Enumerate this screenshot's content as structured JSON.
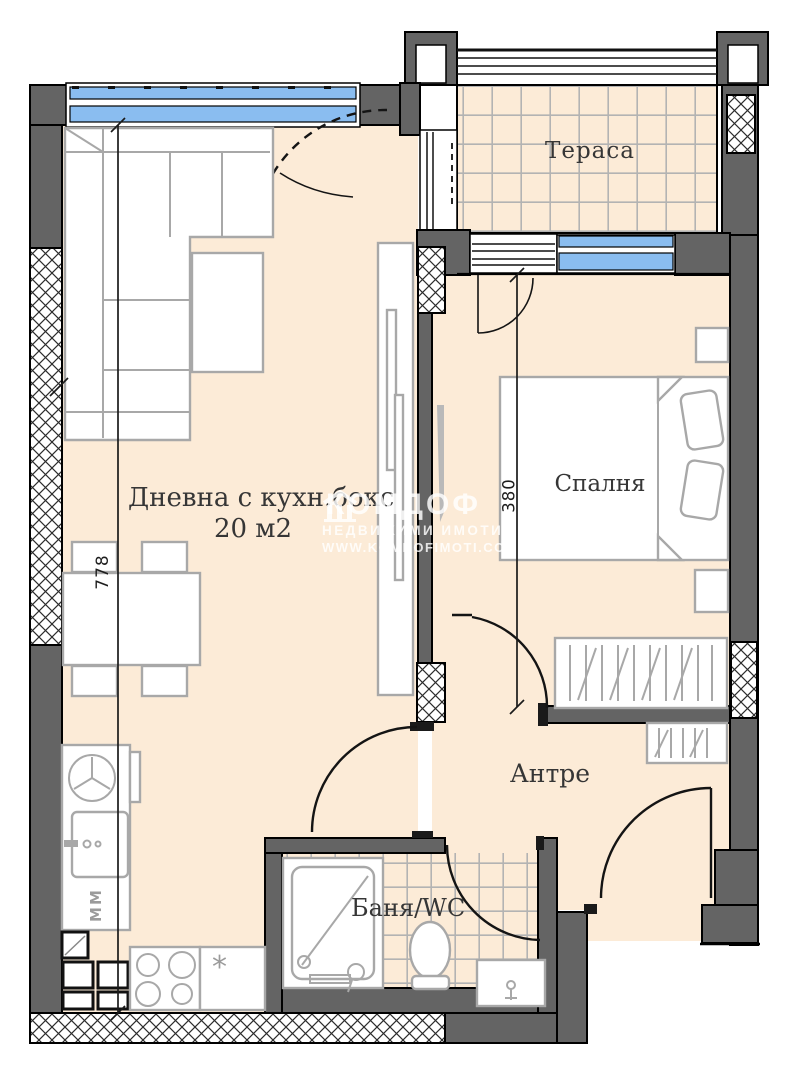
{
  "rooms": {
    "terrace": "Тераса",
    "living": "Дневна с кухн.бокс",
    "living_area": "20 м2",
    "bedroom": "Спалня",
    "hall": "Антре",
    "bath": "Баня/WC"
  },
  "dimensions": {
    "living_length": "778",
    "bedroom_length": "380"
  },
  "appliance_labels": {
    "washing_machine": "ММ",
    "counter_mark": "*"
  },
  "watermark": {
    "logo": "house-icon",
    "brand": "КОМДОФ",
    "line2": "НЕДВИЖИМИ ИМОТИ",
    "line3": "WWW.KOMDOFIMOTI.COM"
  },
  "colors": {
    "wall": "#646464",
    "outline": "#000000",
    "floor": "#fcebd7",
    "window_glass": "#8abdf0",
    "tile_line": "#b3b3b3",
    "furniture_line": "#a8a8a8",
    "label_text": "#363636"
  }
}
